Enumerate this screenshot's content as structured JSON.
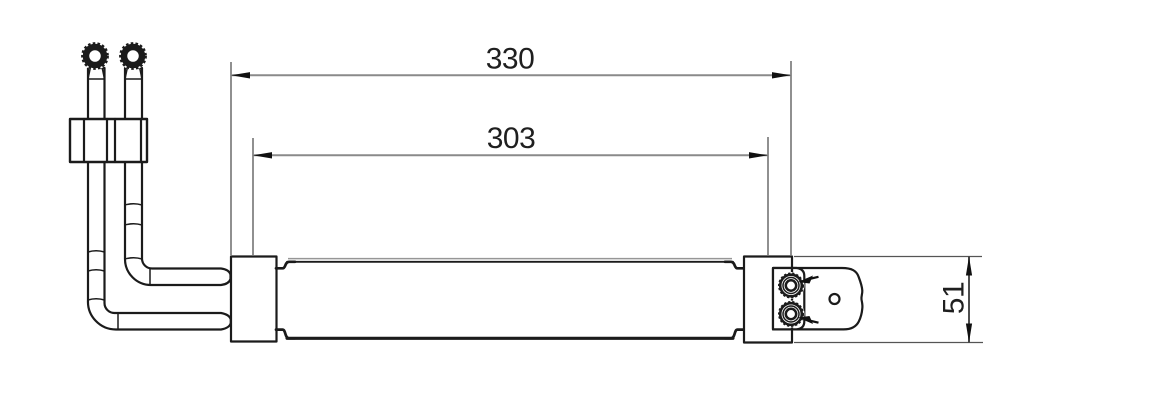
{
  "drawing": {
    "type": "engineering-dimension-drawing",
    "subject": "tube-oil-cooler-side-view"
  },
  "colors": {
    "object_line": "#1b1b1b",
    "dim_line": "#8a8a8a",
    "ext_line": "#555555",
    "arrow": "#111111",
    "text": "#1f1f1f",
    "panel_top_gray": "#969696",
    "background": "#ffffff"
  },
  "dimensions": {
    "overall_length": {
      "label": "330",
      "value": 330,
      "orientation": "horizontal"
    },
    "block_spacing": {
      "label": "303",
      "value": 303,
      "orientation": "horizontal"
    },
    "end_height": {
      "label": "51",
      "value": 51,
      "orientation": "vertical"
    }
  },
  "components": [
    "front-inlet-pipe",
    "rear-outlet-pipe",
    "threaded-pipe-fitting",
    "pipe-clamp-block",
    "left-end-block",
    "core-panel",
    "right-end-block",
    "mounting-bracket",
    "upper-port",
    "lower-port",
    "bracket-hole"
  ]
}
